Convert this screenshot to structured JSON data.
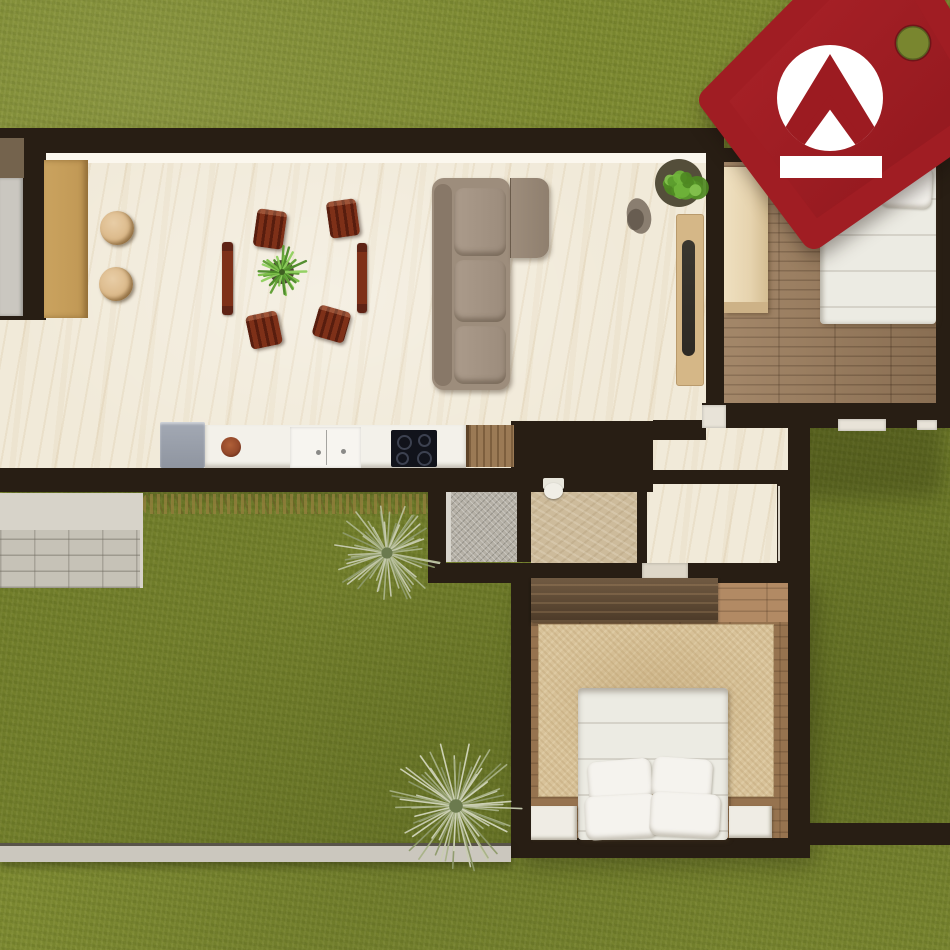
{
  "meta": {
    "type": "3d-floorplan-render",
    "view": "top-down",
    "setting": "single-storey house on lawn"
  },
  "watermark": {
    "shape": "price-tag",
    "emblem": "double-roof-chevron",
    "colors": {
      "body": "#a01d23",
      "body_dark": "#8c161c",
      "emblem": "#9c1b21",
      "medallion": "#ffffff",
      "bar": "#ffffff"
    }
  },
  "palette": {
    "grass": "#79862f",
    "wall": "#281e14",
    "marble": "#f1ead9",
    "countertan": "#c09754",
    "chairrust": "#7e3018",
    "chairdark": "#571d0e",
    "sofa": "#9d8d7c",
    "sofalight": "#ab9b8b",
    "sofadark": "#887868",
    "fridge": "#8f95a0",
    "counterwhite": "#f3f1ea",
    "cooktop": "#11131b",
    "consolewood": "#d5b787",
    "tv": "#2e2a24",
    "woodfloor": "#997b5c",
    "woodfloor2": "#96734f",
    "woodlight": "#b28a64",
    "wardrobelight": "#e6d3ae",
    "wardrobedark": "#5d4731",
    "rug": "#d8c299",
    "bedwhite": "#ecebe3",
    "pillow": "#f5f3ee",
    "nightstand": "#efece4",
    "shower": "#b5b0a6",
    "bath": "#cdbb9b",
    "toilet": "#f0eee6",
    "patio": "#d7d3c9",
    "paver": "#c6c2b7",
    "lowwall": "#cbc7be",
    "stool": "#dcba8b",
    "bowl": "#94492a",
    "tagred": "#a01d23",
    "tagdark": "#8c161c"
  },
  "rooms": [
    {
      "id": "living-dining-kitchen"
    },
    {
      "id": "bedroom-top"
    },
    {
      "id": "bedroom-bottom"
    },
    {
      "id": "bathroom"
    },
    {
      "id": "shower"
    },
    {
      "id": "hallway"
    },
    {
      "id": "courtyard-left"
    },
    {
      "id": "courtyard-right"
    },
    {
      "id": "patio"
    }
  ],
  "furniture": {
    "living": [
      "bar-counter",
      "bar-stool x2",
      "dining-chair x4",
      "dining-bench x2",
      "sectional-sofa",
      "tv-console",
      "tv",
      "potted-plant",
      "rock-sculpture"
    ],
    "kitchen": [
      "refrigerator",
      "counter",
      "serving-bowl",
      "sink-cabinet",
      "cooktop",
      "wood-door"
    ],
    "bedroom_top": [
      "wardrobe",
      "double-bed",
      "pillow x2"
    ],
    "bedroom_bottom": [
      "dresser",
      "area-rug",
      "double-bed",
      "pillow x4",
      "nightstand x2",
      "accent-cushion"
    ],
    "bathroom": [
      "toilet"
    ]
  },
  "decor": {
    "plants": [
      {
        "type": "burst",
        "cx": 282,
        "cy": 272,
        "r": 27,
        "count": 28,
        "seed": 3,
        "colors": [
          "#5e9e33",
          "#7cbf49",
          "#4c8a28",
          "#8fd05e"
        ],
        "center": "#3f5f22",
        "pot": {
          "r": 12,
          "color": "#4a4533"
        }
      },
      {
        "type": "leafy",
        "cx": 679,
        "cy": 183,
        "r": 27,
        "count": 16,
        "seed": 7,
        "colors": [
          "#5a9b2b",
          "#6fb33a",
          "#84c24e",
          "#4e8822"
        ],
        "pot": {
          "r": 24,
          "color": "#544e3a"
        }
      },
      {
        "type": "yucca",
        "cx": 387,
        "cy": 553,
        "r": 56,
        "count": 56,
        "seed": 11,
        "colors": [
          "#c9cdb2",
          "#aab489",
          "#8e9a6b",
          "#b9c09c"
        ],
        "center": "#6b7a4e"
      },
      {
        "type": "yucca",
        "cx": 456,
        "cy": 806,
        "r": 68,
        "count": 62,
        "seed": 23,
        "colors": [
          "#c9cdb2",
          "#a8b287",
          "#8e9a6b",
          "#d2d6bc"
        ],
        "center": "#6b7a4e"
      }
    ],
    "rock": {
      "cx": 639,
      "cy": 216,
      "rx": 12,
      "ry": 18,
      "rot": -12,
      "colors": [
        "#8a7e70",
        "#5f554a"
      ]
    }
  }
}
